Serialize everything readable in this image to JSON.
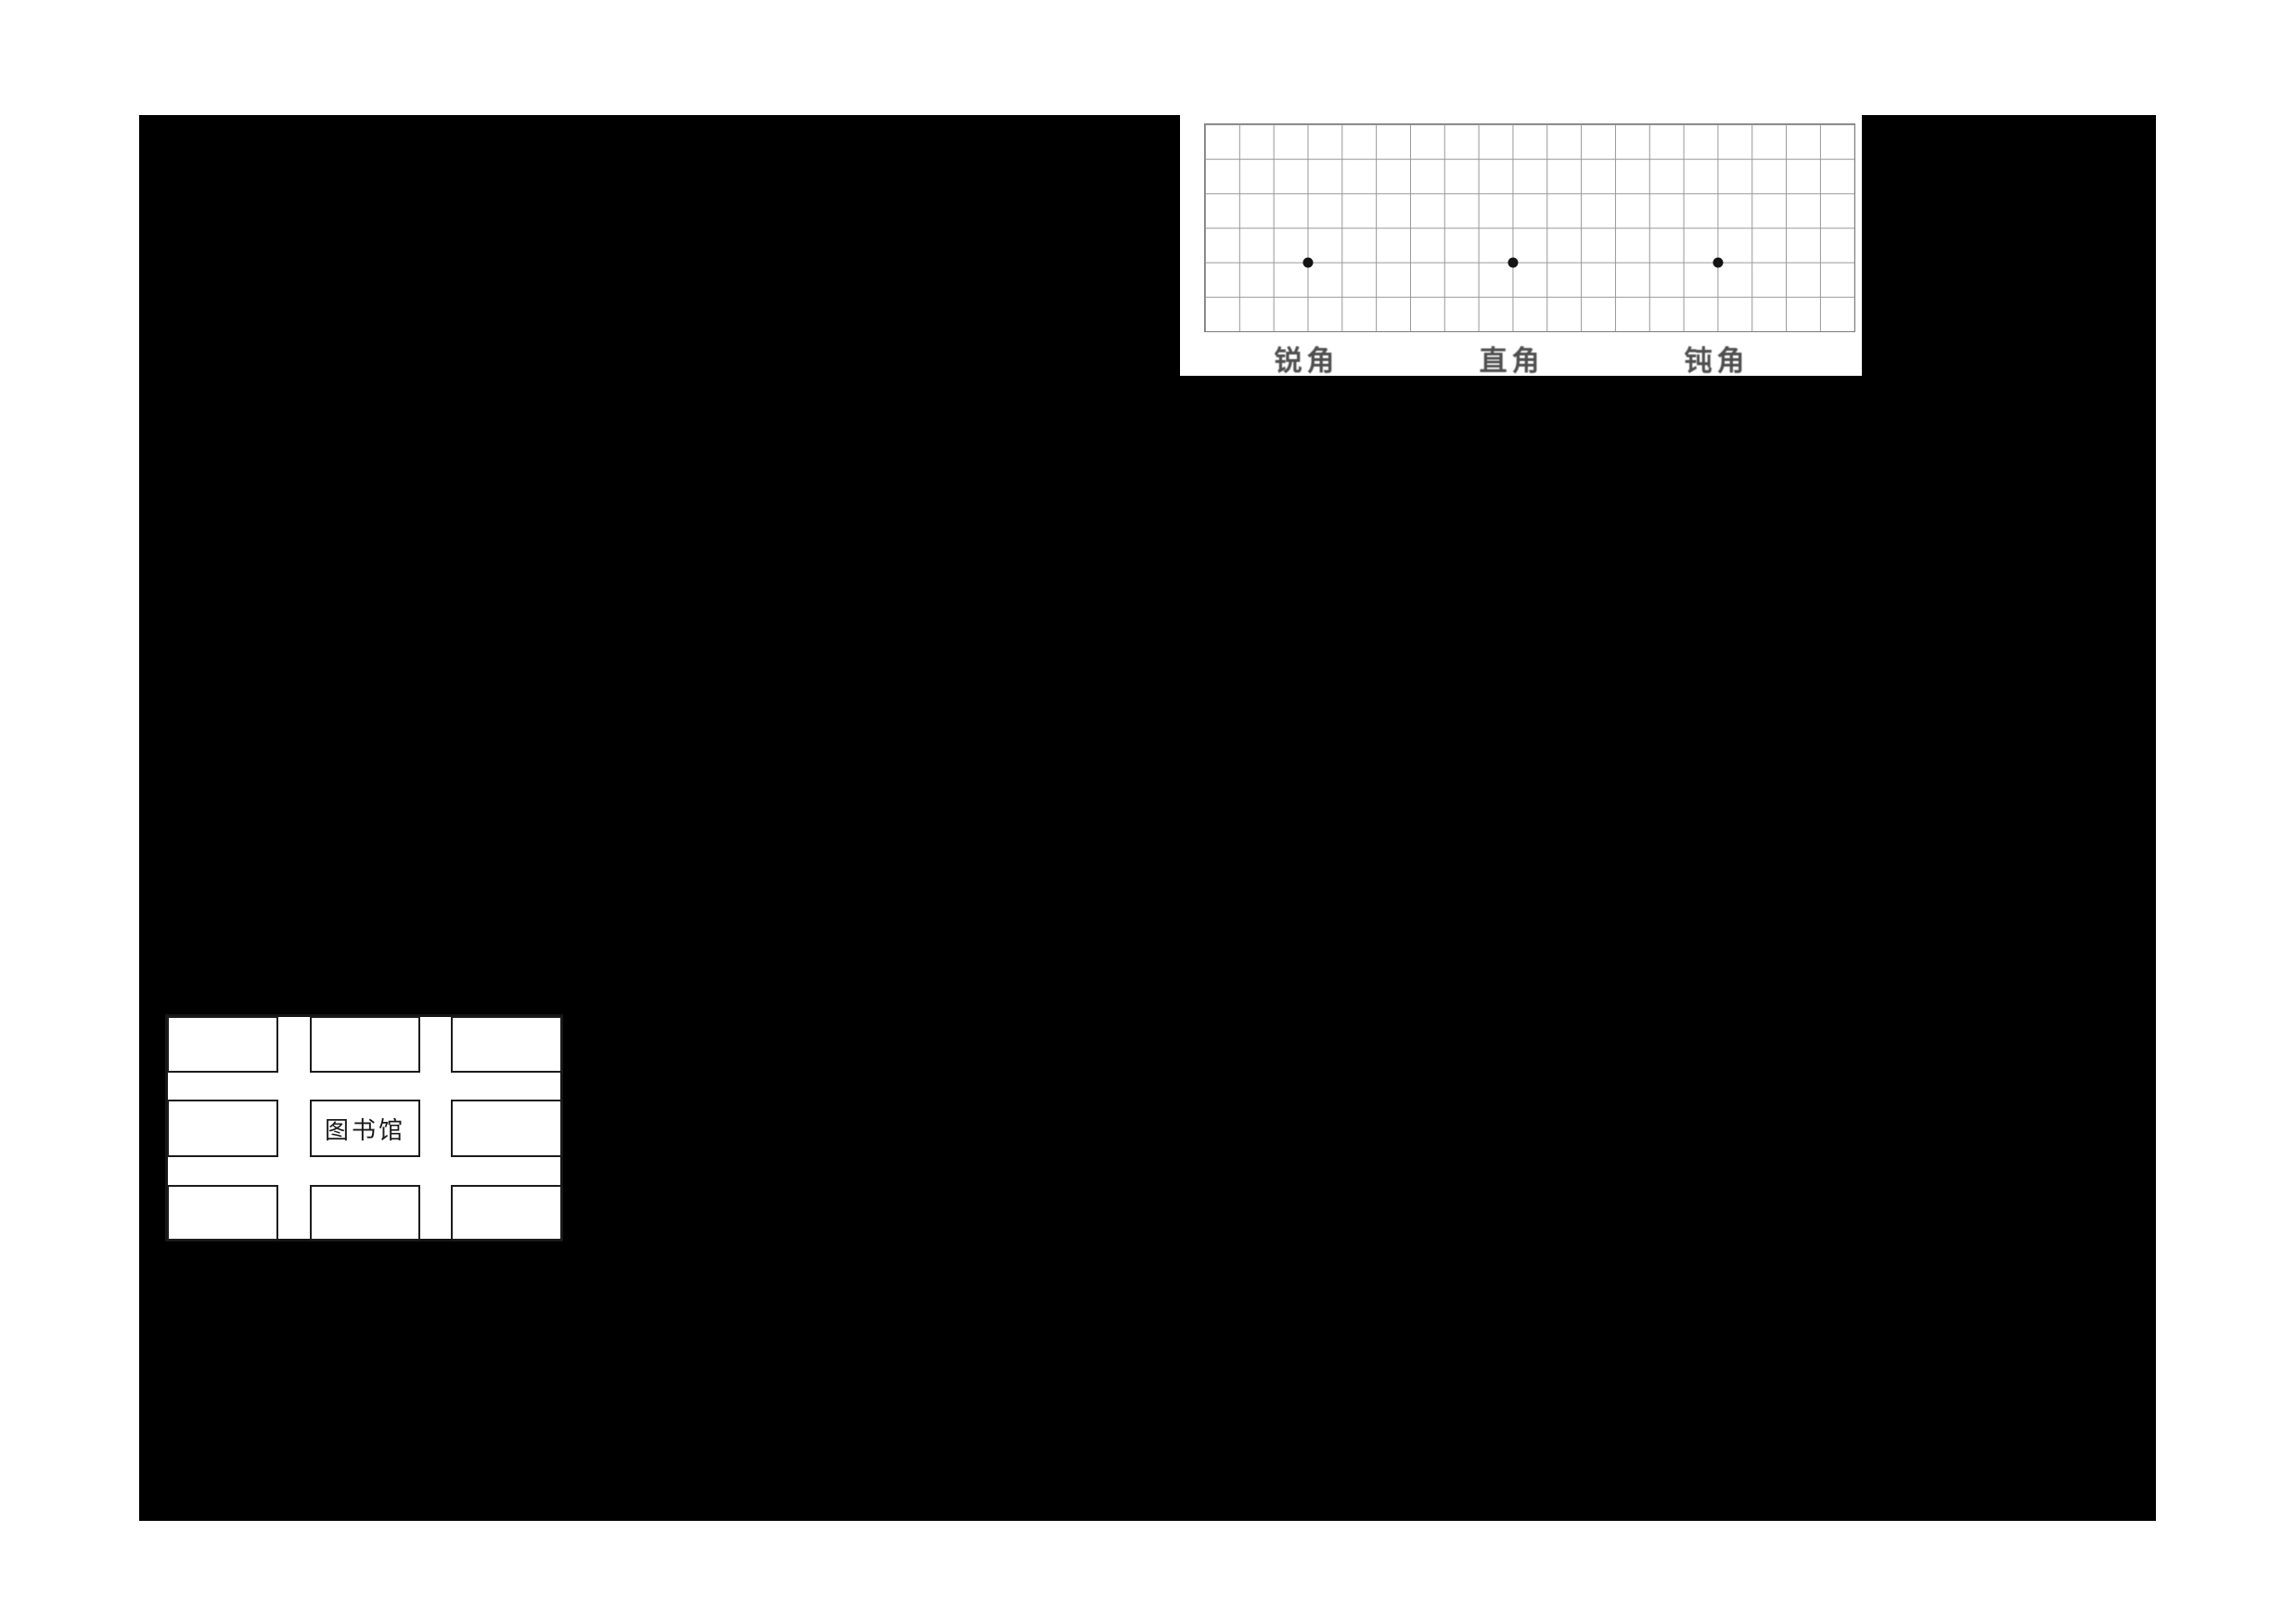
{
  "page": {
    "background_color": "#ffffff",
    "blackout_color": "#000000"
  },
  "figures": {
    "angle_grid": {
      "columns": 19,
      "rows": 6,
      "cell_size_px": 37,
      "line_color": "#989898",
      "border_color": "#7e7e7e",
      "dot_color": "#141414",
      "label_color": "#4f4f4f",
      "dots": [
        {
          "col": 3,
          "row": 4
        },
        {
          "col": 9,
          "row": 4
        },
        {
          "col": 15,
          "row": 4
        }
      ],
      "labels": [
        {
          "text": "锐角",
          "col": 3
        },
        {
          "text": "直角",
          "col": 9
        },
        {
          "text": "钝角",
          "col": 15
        }
      ]
    },
    "library_map": {
      "block_rows": 3,
      "block_cols": 3,
      "center_label": "图书馆",
      "border_color": "#151515",
      "block_border_color": "#1c1c1c"
    }
  }
}
